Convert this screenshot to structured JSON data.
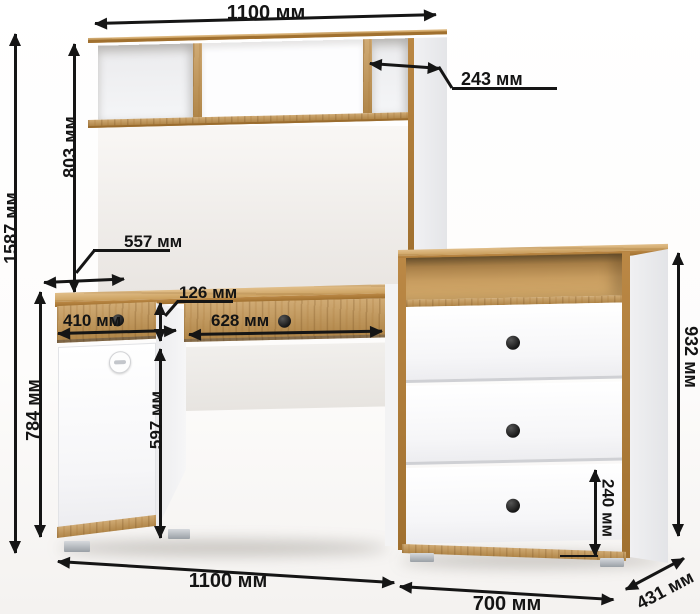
{
  "diagram": {
    "description": "Desk with hutch and chest of drawers - dimension drawing",
    "unit_label": "мм",
    "dimensions": {
      "hutch_width": {
        "value": 1100,
        "label": "1100 мм"
      },
      "shelf_depth": {
        "value": 243,
        "label": "243 мм"
      },
      "hutch_height": {
        "value": 803,
        "label": "803 мм"
      },
      "total_height": {
        "value": 1587,
        "label": "1587 мм"
      },
      "desk_depth": {
        "value": 557,
        "label": "557 мм"
      },
      "drawer_height": {
        "value": 126,
        "label": "126 мм"
      },
      "left_drawer_width": {
        "value": 410,
        "label": "410 мм"
      },
      "center_drawer_width": {
        "value": 628,
        "label": "628 мм"
      },
      "knee_space_height": {
        "value": 597,
        "label": "597 мм"
      },
      "desk_height": {
        "value": 784,
        "label": "784 мм"
      },
      "chest_height": {
        "value": 932,
        "label": "932 мм"
      },
      "bottom_drawer_height": {
        "value": 240,
        "label": "240 мм"
      },
      "desk_width": {
        "value": 1100,
        "label": "1100 мм"
      },
      "chest_width": {
        "value": 700,
        "label": "700 мм"
      },
      "chest_depth": {
        "value": 431,
        "label": "431 мм"
      }
    },
    "colors": {
      "wood": "#c49551",
      "wood_light": "#d7a963",
      "wood_dark": "#a0702f",
      "panel_white": "#f6f6f8",
      "dimension_text": "#141414",
      "knob": "#1c1c1c",
      "feet": "#a8adb3"
    }
  }
}
